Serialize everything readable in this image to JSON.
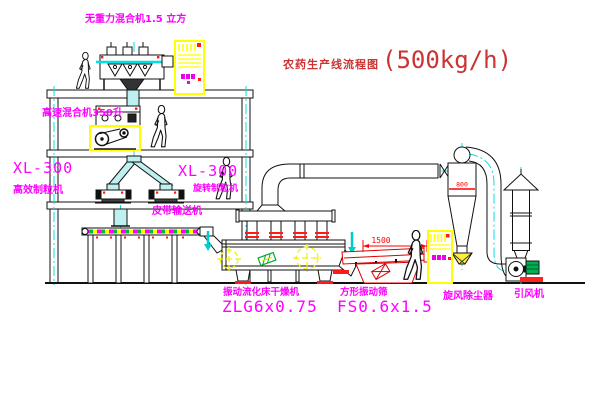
{
  "title": {
    "text": "农药生产线流程图",
    "capacity": "(500kg/h)"
  },
  "labels": {
    "gravity_free_mixer": "无重力混合机1.5 立方",
    "high_speed_mixer": "高速混合机350升",
    "granulator_left_model": "XL-300",
    "granulator_left_name": "高效制粒机",
    "granulator_mid_model": "XL-300",
    "granulator_mid_name": "旋转制粒机",
    "belt_conveyor": "皮带输送机",
    "dryer_name": "振动流化床干燥机",
    "dryer_model": "ZLG6x0.75",
    "screen_name": "方形振动筛",
    "screen_model": "FS0.6x1.5",
    "cyclone": "旋风除尘器",
    "fan": "引风机"
  },
  "dimensions": {
    "screen_length": "1500",
    "screen_height": "541",
    "cyclone_dia": "800"
  },
  "colors": {
    "label": "#ff00ff",
    "title": "#cc3333",
    "dimension": "#ff0000",
    "centerline": "#00e0e0",
    "highlight": "#ffff00",
    "line": "#111111"
  }
}
